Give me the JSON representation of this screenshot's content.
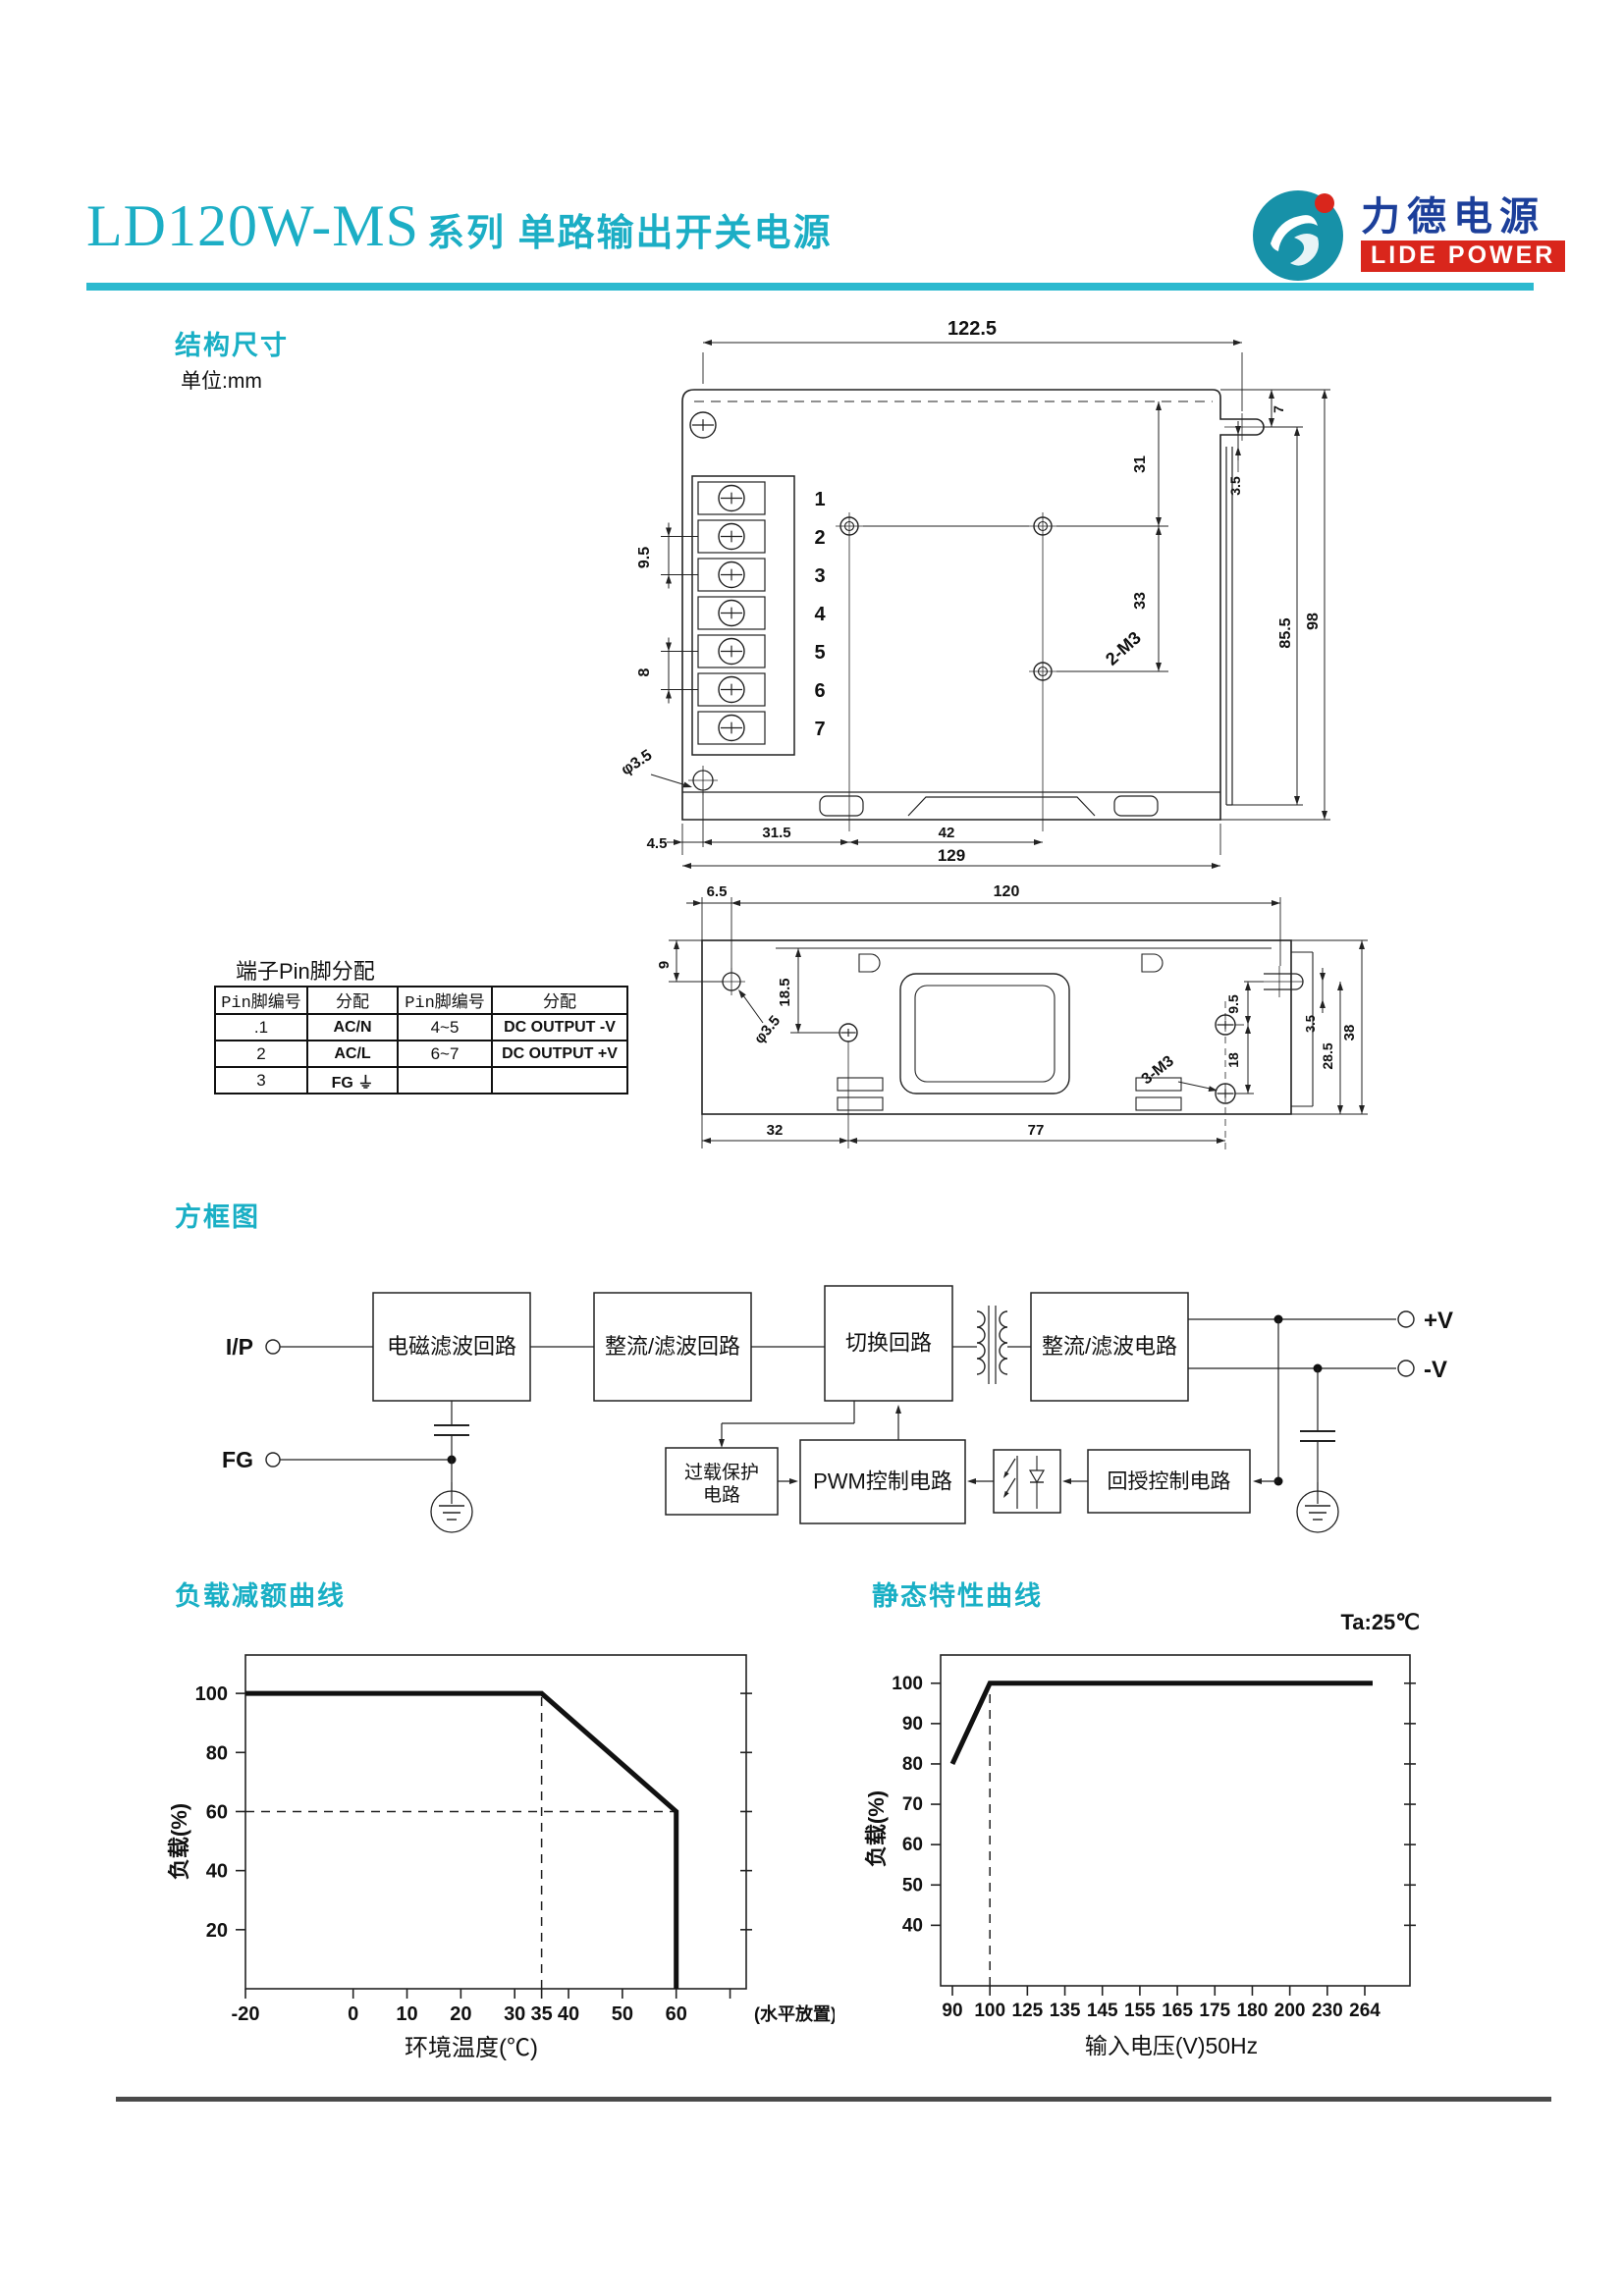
{
  "header": {
    "model": "LD120W-MS",
    "subtitle": "系列 单路输出开关电源",
    "logo": {
      "cn": "力德电源",
      "en": "LIDE POWER",
      "mark_color": "#1791a8",
      "dot_color": "#d9261c",
      "cn_color": "#1c3f9a",
      "en_bg": "#d9261c"
    },
    "accent_color": "#1caec5",
    "rule_color": "#2cb9cf"
  },
  "structure": {
    "heading": "结构尺寸",
    "unit_note": "单位:mm"
  },
  "drawing_top": {
    "pins": [
      "1",
      "2",
      "3",
      "4",
      "5",
      "6",
      "7"
    ],
    "labels": [
      {
        "text": "122.5",
        "x": 395,
        "y": 26,
        "size": 20
      },
      {
        "text": "9.5",
        "x": 66,
        "y": 253,
        "rot": -90,
        "size": 16
      },
      {
        "text": "8",
        "x": 66,
        "y": 370,
        "rot": -90,
        "size": 16
      },
      {
        "text": "2-M3",
        "x": 553,
        "y": 350,
        "rot": -42,
        "size": 18
      },
      {
        "text": "31",
        "x": 571,
        "y": 158,
        "rot": -90,
        "size": 16
      },
      {
        "text": "33",
        "x": 571,
        "y": 297,
        "rot": -90,
        "size": 16
      },
      {
        "text": "7",
        "x": 712,
        "y": 102,
        "rot": -90,
        "size": 14
      },
      {
        "text": "3.5",
        "x": 668,
        "y": 180,
        "rot": -90,
        "size": 14
      },
      {
        "text": "85.5",
        "x": 719,
        "y": 330,
        "rot": -90,
        "size": 16
      },
      {
        "text": "98",
        "x": 747,
        "y": 318,
        "rot": -90,
        "size": 16
      },
      {
        "text": "φ3.5",
        "x": 56,
        "y": 466,
        "rot": -33,
        "size": 16
      },
      {
        "text": "4.5",
        "x": 74,
        "y": 549,
        "size": 15
      },
      {
        "text": "31.5",
        "x": 196,
        "y": 538,
        "size": 15
      },
      {
        "text": "42",
        "x": 369,
        "y": 538,
        "size": 15
      },
      {
        "text": "129",
        "x": 374,
        "y": 562,
        "size": 17
      }
    ]
  },
  "drawing_side": {
    "labels": [
      {
        "text": "6.5",
        "x": 75,
        "y": 33,
        "size": 15
      },
      {
        "text": "120",
        "x": 370,
        "y": 33,
        "size": 16
      },
      {
        "text": "9",
        "x": 26,
        "y": 103,
        "rot": -90,
        "size": 15
      },
      {
        "text": "φ3.5",
        "x": 130,
        "y": 172,
        "rot": -50,
        "size": 15
      },
      {
        "text": "18.5",
        "x": 149,
        "y": 131,
        "rot": -90,
        "size": 15
      },
      {
        "text": "3-M3",
        "x": 527,
        "y": 214,
        "rot": -38,
        "size": 16
      },
      {
        "text": "9.5",
        "x": 606,
        "y": 143,
        "rot": -90,
        "size": 14
      },
      {
        "text": "18",
        "x": 606,
        "y": 200,
        "rot": -90,
        "size": 14
      },
      {
        "text": "3.5",
        "x": 684,
        "y": 163,
        "rot": -90,
        "size": 13
      },
      {
        "text": "28.5",
        "x": 702,
        "y": 196,
        "rot": -90,
        "size": 14
      },
      {
        "text": "38",
        "x": 724,
        "y": 172,
        "rot": -90,
        "size": 15
      },
      {
        "text": "32",
        "x": 134,
        "y": 276,
        "size": 15
      },
      {
        "text": "77",
        "x": 400,
        "y": 276,
        "size": 15
      }
    ]
  },
  "pin_table": {
    "title": "端子Pin脚分配",
    "headers": [
      "Pin脚编号",
      "分配",
      "Pin脚编号",
      "分配"
    ],
    "rows": [
      [
        ".1",
        "AC/N",
        "4~5",
        "DC OUTPUT -V"
      ],
      [
        "2",
        "AC/L",
        "6~7",
        "DC OUTPUT +V"
      ],
      [
        "3",
        "FG ⏚",
        "",
        ""
      ]
    ]
  },
  "block_diagram": {
    "heading": "方框图",
    "terminals": {
      "input": "I/P",
      "ground": "FG"
    },
    "outputs": {
      "pos": "+V",
      "neg": "-V"
    },
    "blocks": {
      "emi": "电磁滤波回路",
      "rectify_in": "整流/滤波回路",
      "switching": "切换回路",
      "rectify_out": "整流/滤波电路",
      "overload": [
        "过载保护",
        "电路"
      ],
      "pwm": "PWM控制电路",
      "feedback": "回授控制电路"
    }
  },
  "chart_data": [
    {
      "type": "line",
      "title": "负载减额曲线",
      "xlabel": "环境温度(℃)",
      "ylabel": "负载(%)",
      "x_ticks": [
        -20,
        0,
        10,
        20,
        30,
        35,
        40,
        50,
        60
      ],
      "x_extra_tick": 70,
      "xlim": [
        -20,
        73
      ],
      "y_ticks": [
        20,
        40,
        60,
        80,
        100
      ],
      "ylim": [
        0,
        113
      ],
      "grid": false,
      "series": [
        {
          "name": "load",
          "points": [
            [
              -20,
              100
            ],
            [
              35,
              100
            ],
            [
              60,
              60
            ],
            [
              60,
              0
            ]
          ]
        }
      ],
      "dashed_guides": {
        "v": 35,
        "h": 60,
        "h_to_x": 60
      },
      "right_note": "(水平放置)"
    },
    {
      "type": "line",
      "title": "静态特性曲线",
      "corner_label": "Ta:25℃",
      "xlabel": "输入电压(V)50Hz",
      "ylabel": "负载(%)",
      "x_scale": "categorical",
      "x_ticks": [
        90,
        100,
        125,
        135,
        145,
        155,
        165,
        175,
        180,
        200,
        230,
        264
      ],
      "y_ticks": [
        40,
        50,
        60,
        70,
        80,
        90,
        100
      ],
      "ylim": [
        25,
        107
      ],
      "grid": false,
      "series": [
        {
          "name": "load",
          "points": [
            [
              90,
              80
            ],
            [
              100,
              100
            ],
            [
              264,
              100
            ]
          ]
        }
      ],
      "dashed_guides": {
        "v": 100
      }
    }
  ]
}
